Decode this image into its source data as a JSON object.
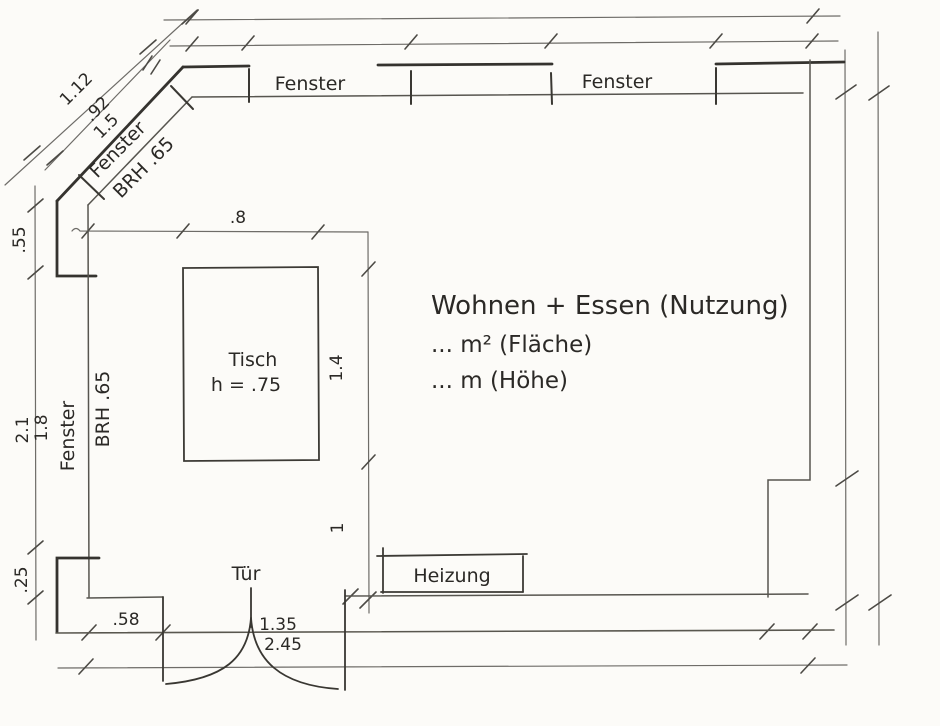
{
  "colors": {
    "paper": "#fcfbf8",
    "wall_ink": "#35332f",
    "thin_line_ink": "#6e6c68",
    "text_ink": "#2b2926"
  },
  "diagonal_wall": {
    "dim_outer": "1.12",
    "dim_mid": ".92",
    "dim_inner": "1.5",
    "window_label": "Fenster",
    "sill_label": "BRH .65"
  },
  "top_wall": {
    "window_left_label": "Fenster",
    "window_right_label": "Fenster"
  },
  "left_wall": {
    "dim_top": ".55",
    "dim_wall": "2.1",
    "dim_window": "1.8",
    "window_label": "Fenster",
    "sill_label": "BRH .65",
    "dim_bottom": ".25"
  },
  "bottom_wall": {
    "dim_left": ".58",
    "door": {
      "label": "Tür",
      "width": "1.35",
      "height": "2.45"
    },
    "heater_label": "Heizung"
  },
  "interior": {
    "table": {
      "label": "Tisch",
      "height_note": "h = .75",
      "dim_width": ".8",
      "dim_depth": "1.4",
      "dim_clearance": "1"
    },
    "room_text": {
      "usage": "Wohnen + Essen (Nutzung)",
      "area": "... m² (Fläche)",
      "height": "... m (Höhe)"
    }
  }
}
